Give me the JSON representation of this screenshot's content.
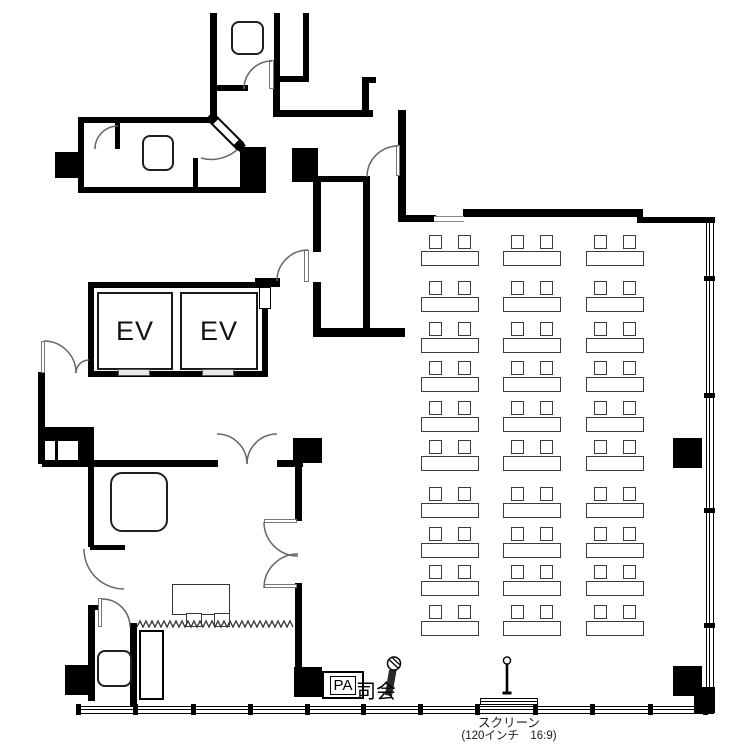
{
  "title": "会議室レイアウト平面図",
  "labels": {
    "elevator_1": "EV",
    "elevator_2": "EV",
    "pa_box": "PA",
    "moderator": "司会",
    "screen_title": "スクリーン",
    "screen_spec": "(120インチ　16:9)"
  },
  "colors": {
    "wall": "#000000",
    "female_icon": "#e60012",
    "male_icon": "#2433d6",
    "door_arc": "#666666"
  },
  "signs": [
    {
      "name": "female-restroom-icon"
    },
    {
      "name": "male-restroom-icon"
    },
    {
      "name": "luggage-cloakroom-icon"
    },
    {
      "name": "smoking-area-icon"
    },
    {
      "name": "microphone-icon"
    },
    {
      "name": "mic-stand-icon"
    }
  ],
  "seminar_seating": {
    "columns_x": [
      421,
      503,
      586
    ],
    "rows_y": [
      235,
      281,
      322,
      361,
      401,
      440,
      487,
      527,
      565,
      605
    ],
    "desk_width": 58,
    "desk_height": 15,
    "desk_offset_y": 16,
    "chair_width": 13,
    "chair_height": 14,
    "chair_offsets_x": [
      8,
      37
    ],
    "desks_total": 30,
    "seats_total": 60
  },
  "operator_area": {
    "table": {
      "x": 172,
      "y": 584,
      "w": 58,
      "h": 31,
      "chairs": 2
    },
    "zigzag_partition": {
      "x1": 137,
      "x2": 293,
      "y": 627,
      "tooth": 6,
      "amp": 6
    }
  },
  "windows": {
    "bottom_mullions_x": [
      78,
      135,
      193,
      250,
      307,
      363,
      420,
      477,
      535,
      592,
      650,
      705
    ],
    "right_mullions_y": [
      278,
      395,
      510,
      625
    ]
  }
}
